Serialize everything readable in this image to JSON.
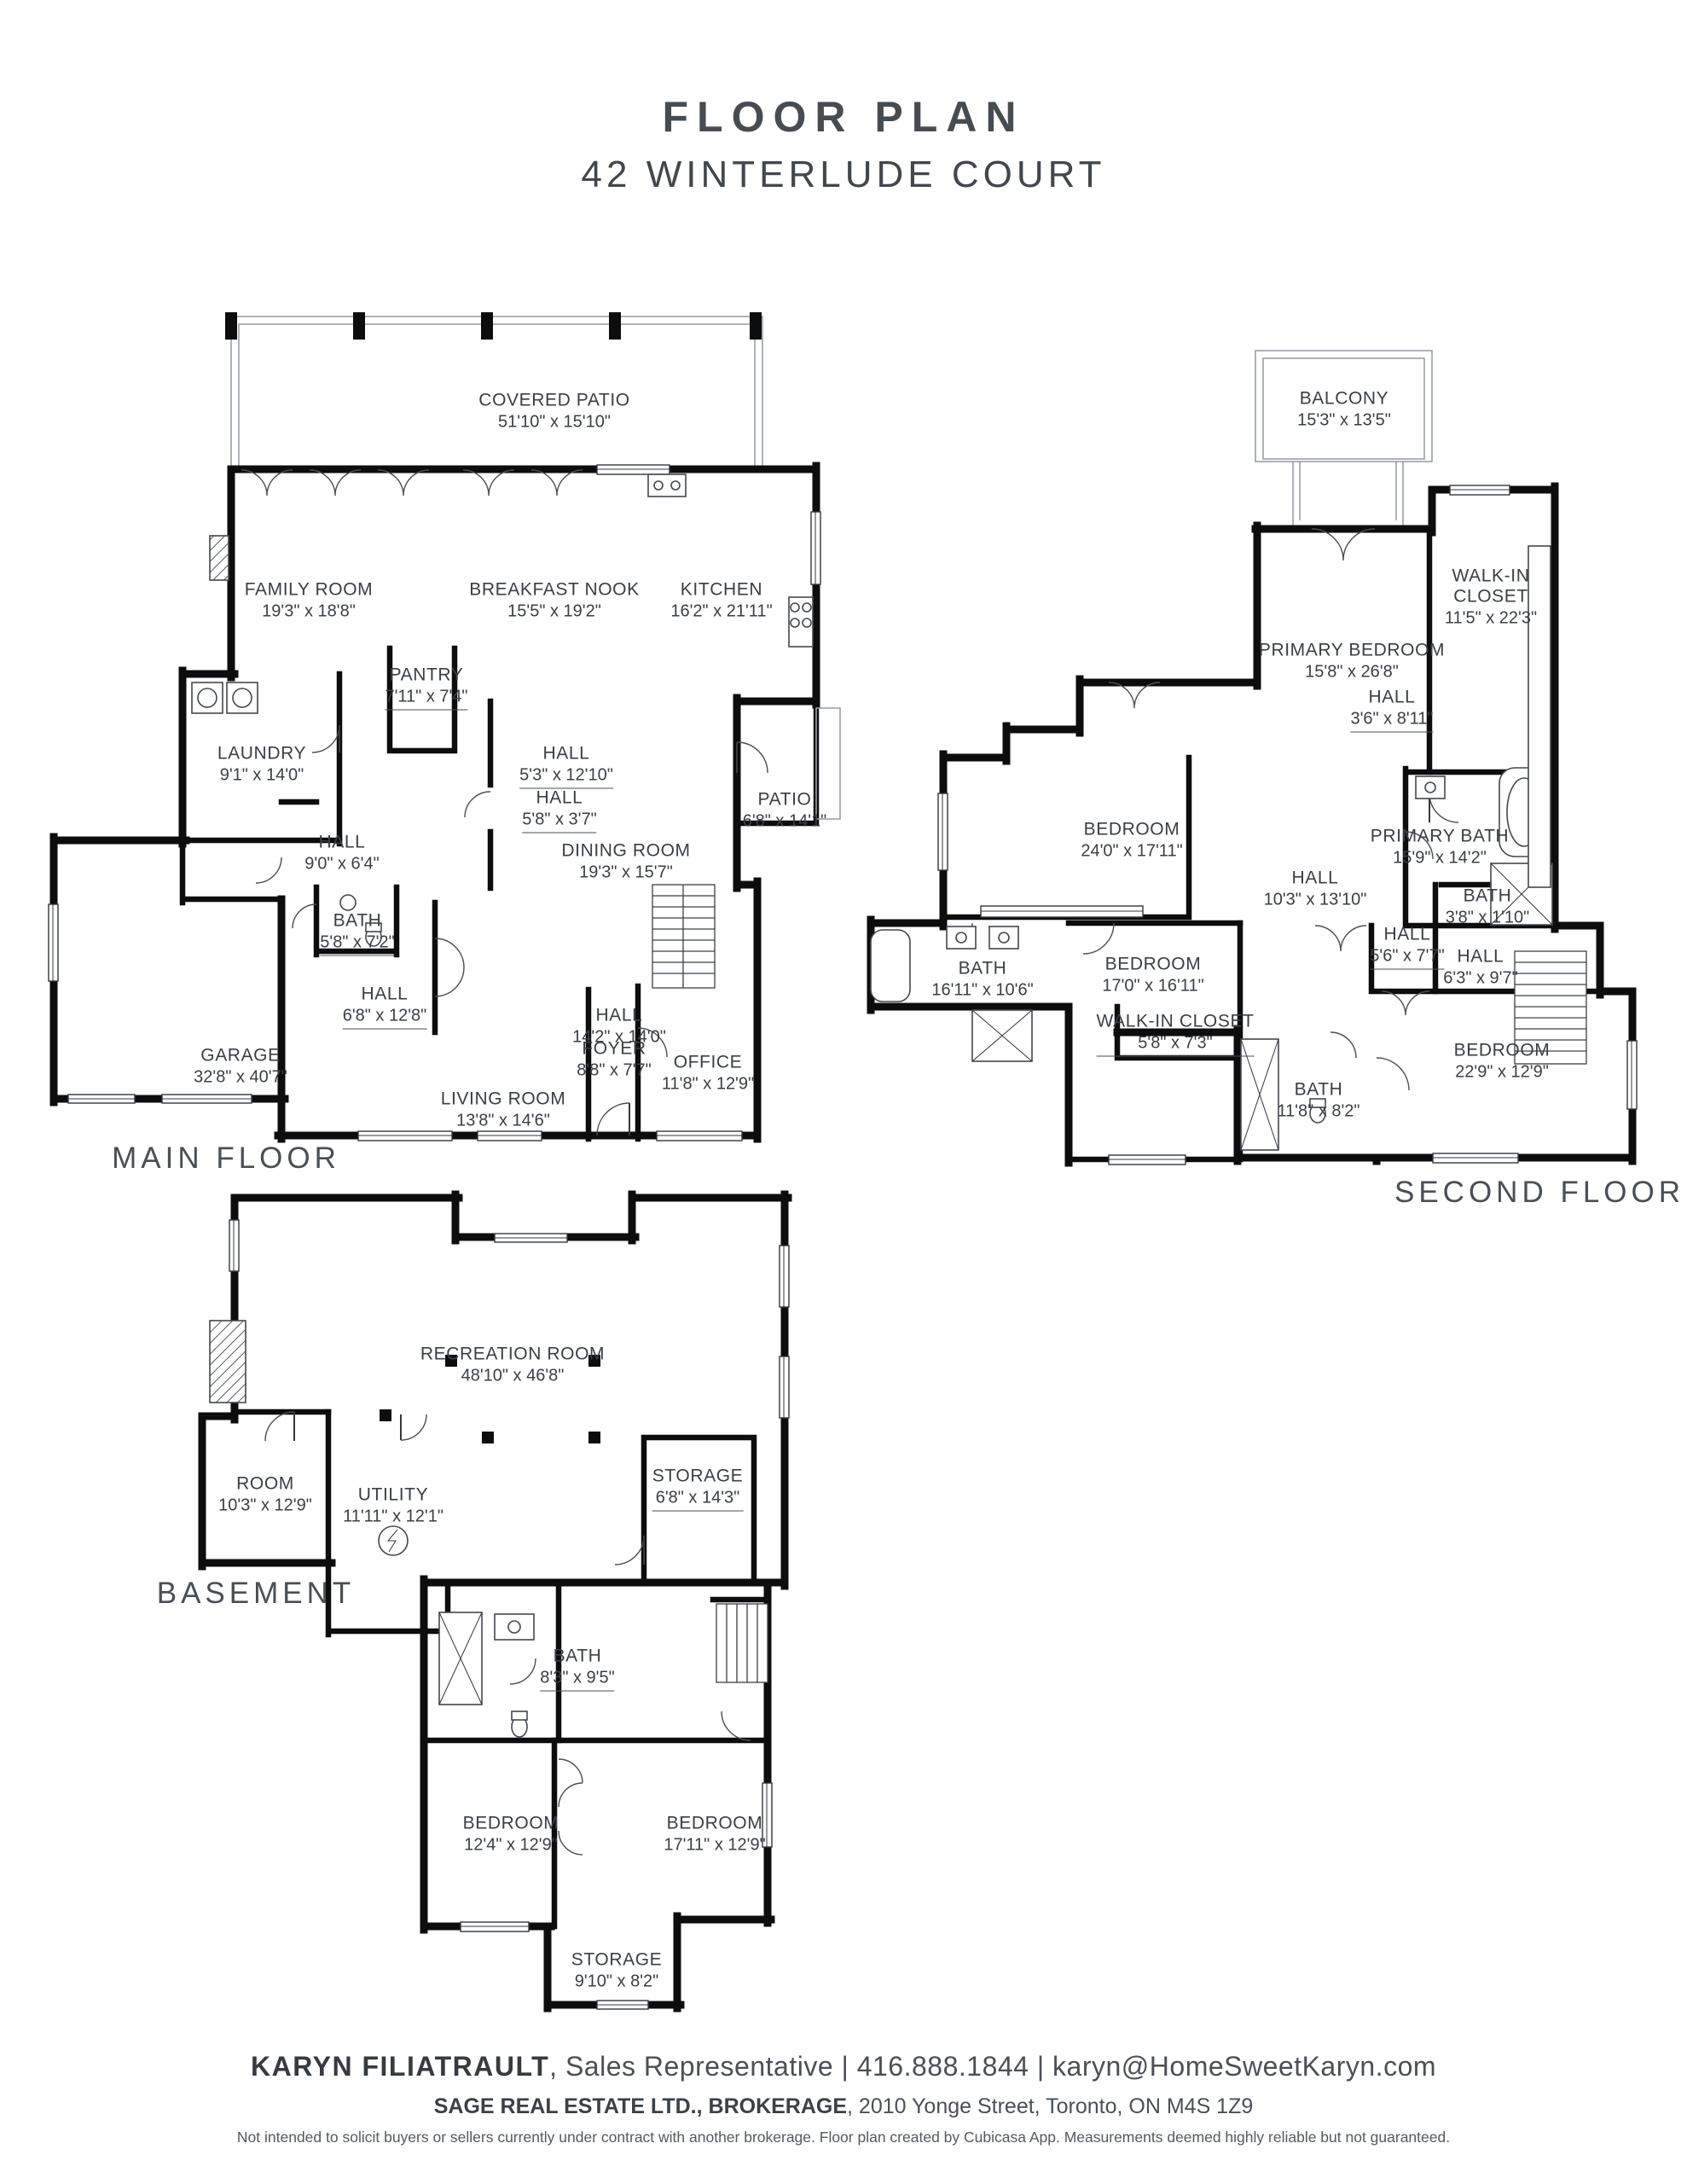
{
  "title": {
    "line1": "FLOOR PLAN",
    "line2": "42 WINTERLUDE COURT"
  },
  "colors": {
    "wall": "#0d0d0d",
    "thin_wall": "#9aa0a8",
    "text": "#3a3f45"
  },
  "floors": {
    "main": {
      "label": "MAIN FLOOR",
      "rooms": {
        "covered_patio": {
          "name": "COVERED PATIO",
          "dims": "51'10\" x 15'10\""
        },
        "family_room": {
          "name": "FAMILY ROOM",
          "dims": "19'3\" x 18'8\""
        },
        "breakfast_nook": {
          "name": "BREAKFAST NOOK",
          "dims": "15'5\" x 19'2\""
        },
        "kitchen": {
          "name": "KITCHEN",
          "dims": "16'2\" x 21'11\""
        },
        "pantry": {
          "name": "PANTRY",
          "dims": "7'11\" x 7'4\""
        },
        "laundry": {
          "name": "LAUNDRY",
          "dims": "9'1\" x 14'0\""
        },
        "hall_a": {
          "name": "HALL",
          "dims": "5'3\" x 12'10\""
        },
        "hall_b": {
          "name": "HALL",
          "dims": "5'8\" x 3'7\""
        },
        "hall_c": {
          "name": "HALL",
          "dims": "9'0\" x 6'4\""
        },
        "bath": {
          "name": "BATH",
          "dims": "5'8\" x 7'2\""
        },
        "dining_room": {
          "name": "DINING ROOM",
          "dims": "19'3\" x 15'7\""
        },
        "patio": {
          "name": "PATIO",
          "dims": "6'8\" x 14'1\""
        },
        "hall_d": {
          "name": "HALL",
          "dims": "6'8\" x 12'8\""
        },
        "hall_e": {
          "name": "HALL",
          "dims": "14'2\" x 14'0\""
        },
        "garage": {
          "name": "GARAGE",
          "dims": "32'8\" x 40'7\""
        },
        "living_room": {
          "name": "LIVING ROOM",
          "dims": "13'8\" x 14'6\""
        },
        "foyer": {
          "name": "FOYER",
          "dims": "8'8\" x 7'7\""
        },
        "office": {
          "name": "OFFICE",
          "dims": "11'8\" x 12'9\""
        }
      }
    },
    "second": {
      "label": "SECOND FLOOR",
      "rooms": {
        "balcony": {
          "name": "BALCONY",
          "dims": "15'3\" x 13'5\""
        },
        "walk_in_closet": {
          "name": "WALK-IN CLOSET",
          "dims": "11'5\" x 22'3\""
        },
        "primary_bedroom": {
          "name": "PRIMARY BEDROOM",
          "dims": "15'8\" x 26'8\""
        },
        "hall_a": {
          "name": "HALL",
          "dims": "3'6\" x 8'11\""
        },
        "bedroom_a": {
          "name": "BEDROOM",
          "dims": "24'0\" x 17'11\""
        },
        "primary_bath": {
          "name": "PRIMARY BATH",
          "dims": "15'9\" x 14'2\""
        },
        "hall_b": {
          "name": "HALL",
          "dims": "10'3\" x 13'10\""
        },
        "bath_b": {
          "name": "BATH",
          "dims": "3'8\" x 1'10\""
        },
        "hall_c": {
          "name": "HALL",
          "dims": "5'6\" x 7'7\""
        },
        "hall_d": {
          "name": "HALL",
          "dims": "6'3\" x 9'7\""
        },
        "bath_a": {
          "name": "BATH",
          "dims": "16'11\" x 10'6\""
        },
        "bedroom_b": {
          "name": "BEDROOM",
          "dims": "17'0\" x 16'11\""
        },
        "walk_in_closet_b": {
          "name": "WALK-IN CLOSET",
          "dims": "5'8\" x 7'3\""
        },
        "bath_c": {
          "name": "BATH",
          "dims": "11'8\" x 8'2\""
        },
        "bedroom_c": {
          "name": "BEDROOM",
          "dims": "22'9\" x 12'9\""
        }
      }
    },
    "basement": {
      "label": "BASEMENT",
      "rooms": {
        "recreation_room": {
          "name": "RECREATION ROOM",
          "dims": "48'10\" x 46'8\""
        },
        "room": {
          "name": "ROOM",
          "dims": "10'3\" x 12'9\""
        },
        "utility": {
          "name": "UTILITY",
          "dims": "11'11\" x 12'1\""
        },
        "storage_a": {
          "name": "STORAGE",
          "dims": "6'8\" x 14'3\""
        },
        "bath": {
          "name": "BATH",
          "dims": "8'3\" x 9'5\""
        },
        "bedroom_a": {
          "name": "BEDROOM",
          "dims": "12'4\" x 12'9\""
        },
        "bedroom_b": {
          "name": "BEDROOM",
          "dims": "17'11\" x 12'9\""
        },
        "storage_b": {
          "name": "STORAGE",
          "dims": "9'10\" x 8'2\""
        }
      }
    }
  },
  "footer": {
    "agent_name": "KARYN FILIATRAULT",
    "agent_rest": ", Sales Representative | 416.888.1844 | karyn@HomeSweetKaryn.com",
    "brokerage_name": "SAGE REAL ESTATE LTD., BROKERAGE",
    "brokerage_rest": ", 2010 Yonge Street, Toronto, ON M4S 1Z9",
    "disclaimer": "Not intended to solicit buyers or sellers currently under contract with another brokerage. Floor plan created by Cubicasa App. Measurements deemed highly reliable but not guaranteed."
  }
}
